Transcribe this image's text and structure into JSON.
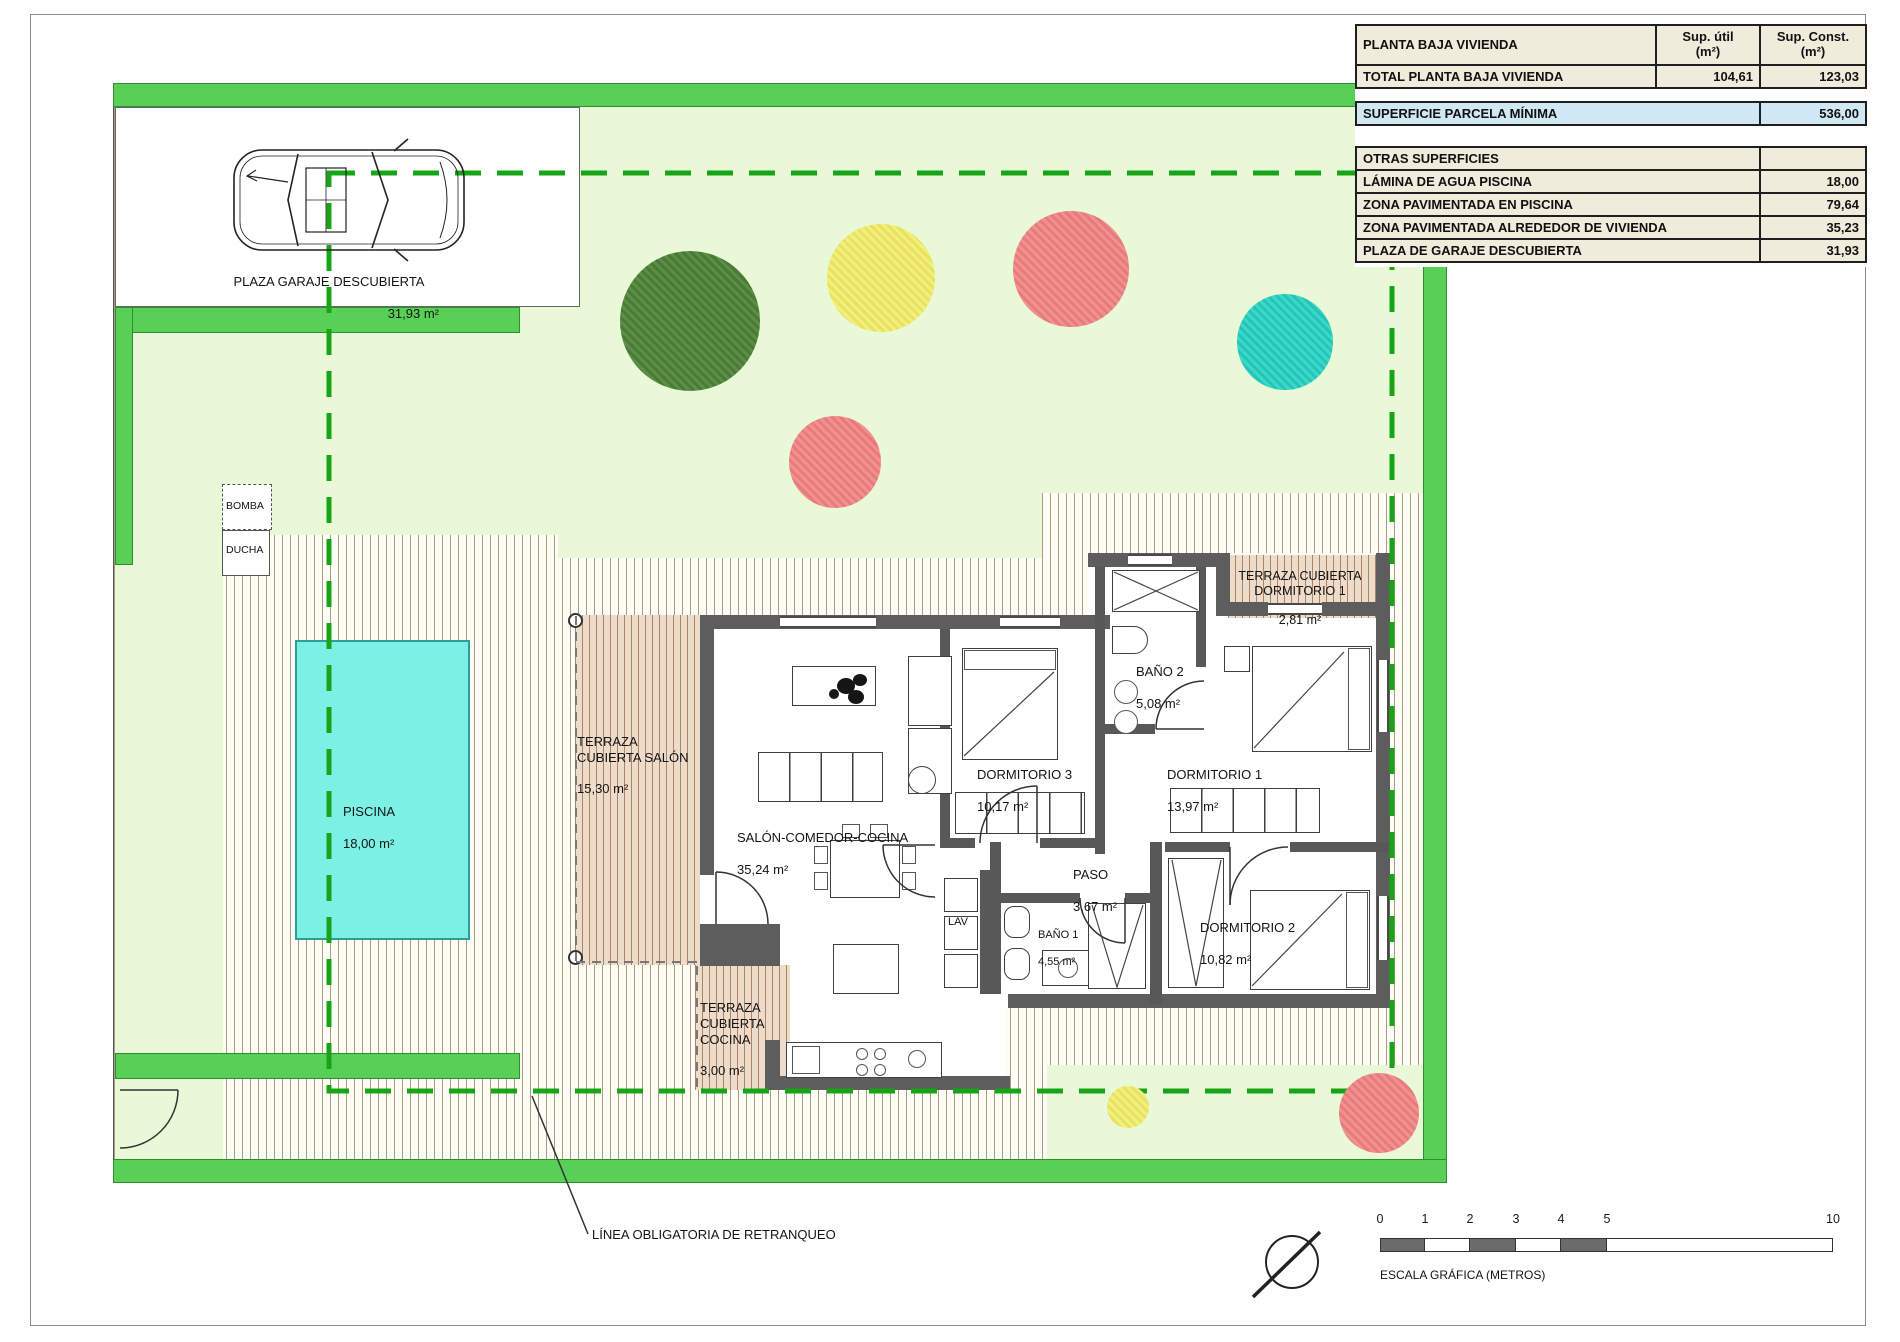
{
  "table": {
    "header": {
      "label": "PLANTA BAJA VIVIENDA",
      "util": "Sup. útil\n(m²)",
      "const": "Sup. Const.\n(m²)"
    },
    "total": {
      "label": "TOTAL PLANTA BAJA VIVIENDA",
      "util": "104,61",
      "const": "123,03"
    },
    "parcela": {
      "label": "SUPERFICIE PARCELA MÍNIMA",
      "value": "536,00"
    },
    "otras_title": "OTRAS SUPERFICIES",
    "otras_rows": [
      {
        "label": "LÁMINA DE AGUA PISCINA",
        "value": "18,00"
      },
      {
        "label": "ZONA PAVIMENTADA EN PISCINA",
        "value": "79,64"
      },
      {
        "label": "ZONA PAVIMENTADA ALREDEDOR DE VIVIENDA",
        "value": "35,23"
      },
      {
        "label": "PLAZA DE GARAJE DESCUBIERTA",
        "value": "31,93"
      }
    ]
  },
  "plan": {
    "garage": {
      "name": "PLAZA GARAJE DESCUBIERTA",
      "area": "31,93 m²"
    },
    "piscina": {
      "name": "PISCINA",
      "area": "18,00 m²"
    },
    "terraza_salon": {
      "name": "TERRAZA\nCUBIERTA SALÓN",
      "area": "15,30 m²"
    },
    "salon": {
      "name": "SALÓN-COMEDOR-COCINA",
      "area": "35,24 m²"
    },
    "dorm3": {
      "name": "DORMITORIO 3",
      "area": "10,17 m²"
    },
    "bano2": {
      "name": "BAÑO 2",
      "area": "5,08 m²"
    },
    "dorm1": {
      "name": "DORMITORIO 1",
      "area": "13,97 m²"
    },
    "terraza_dorm1": {
      "name": "TERRAZA CUBIERTA\nDORMITORIO 1",
      "area": "2,81 m²"
    },
    "paso": {
      "name": "PASO",
      "area": "3,67 m²"
    },
    "bano1": {
      "name": "BAÑO 1",
      "area": "4,55 m²"
    },
    "dorm2": {
      "name": "DORMITORIO 2",
      "area": "10,82 m²"
    },
    "terraza_cocina": {
      "name": "TERRAZA\nCUBIERTA\nCOCINA",
      "area": "3,00 m²"
    },
    "lav": "LAV",
    "bomba": "BOMBA",
    "ducha": "DUCHA"
  },
  "annotations": {
    "retranqueo": "LÍNEA OBLIGATORIA DE RETRANQUEO"
  },
  "scale": {
    "ticks": [
      "0",
      "1",
      "2",
      "3",
      "4",
      "5",
      "10"
    ],
    "caption": "ESCALA GRÁFICA (METROS)"
  },
  "colors": {
    "parcel_band": "#58d058",
    "garden": "#e9f8d6",
    "pool": "#7df0e6",
    "retranqueo_line": "#17a517",
    "highlight_row": "#cfe8f4",
    "tree_green": "#4a7a38",
    "tree_yellow": "#ede362",
    "tree_salmon": "#ef8585",
    "tree_teal": "#2fc9ba",
    "wall": "#5d5d5d"
  }
}
